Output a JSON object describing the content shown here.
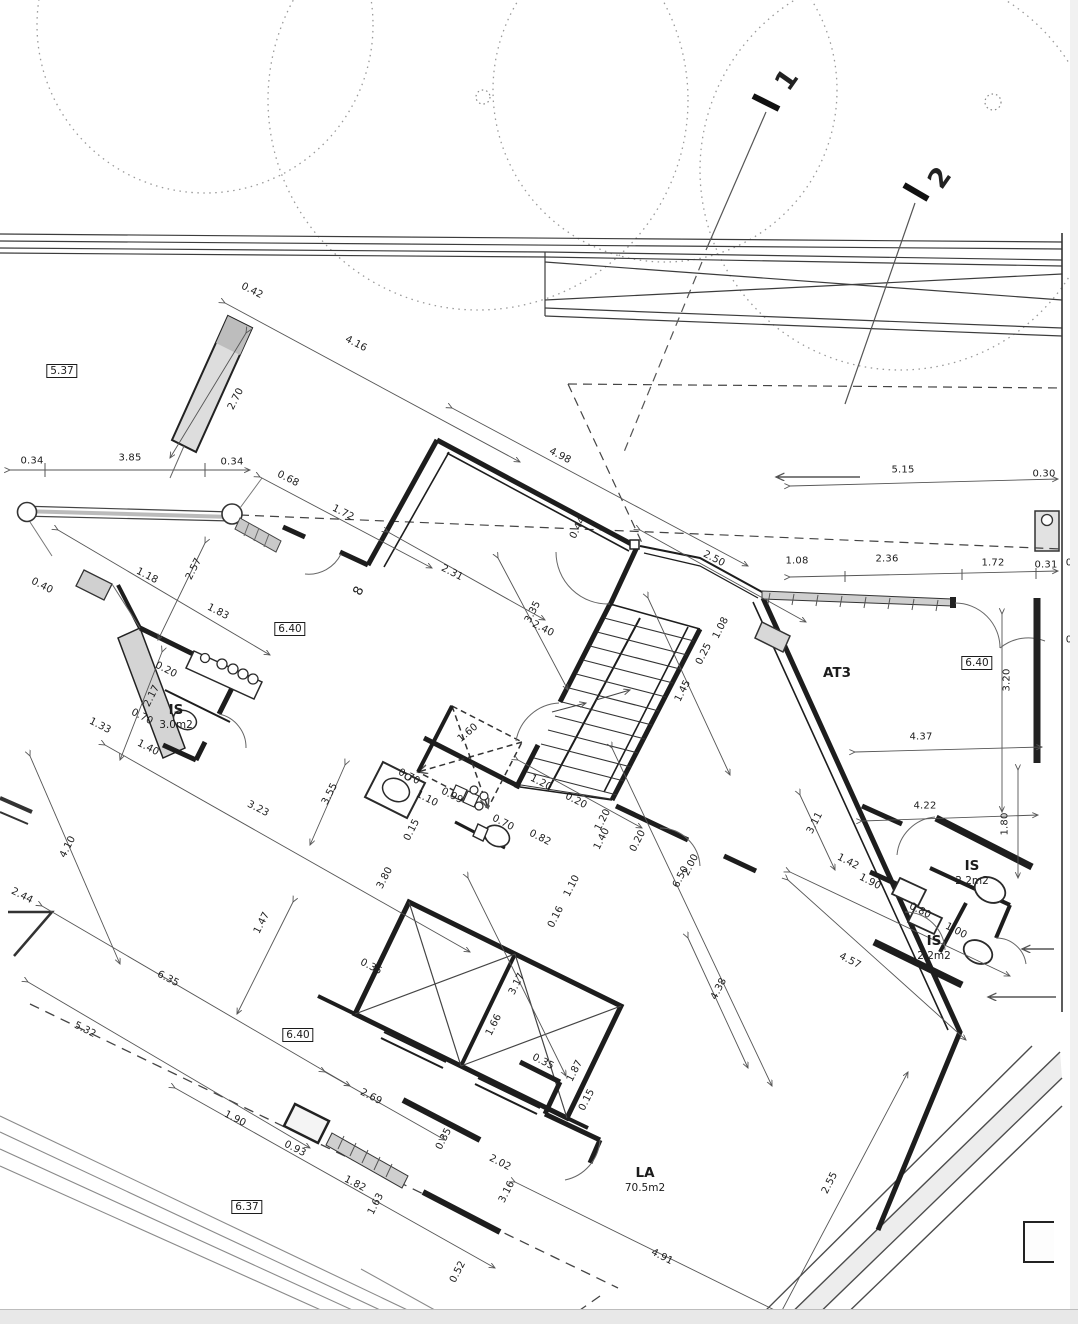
{
  "page": {
    "width": 1078,
    "height": 1324
  },
  "floorplan": {
    "section_markers": [
      {
        "label": "1",
        "x": 787,
        "y": 80,
        "r": -55
      },
      {
        "label": "2",
        "x": 940,
        "y": 178,
        "r": -55
      }
    ],
    "level_markers": [
      {
        "value": "5.37",
        "x": 62,
        "y": 371
      },
      {
        "value": "6.40",
        "x": 290,
        "y": 629
      },
      {
        "value": "6.40",
        "x": 977,
        "y": 663
      },
      {
        "value": "6.40",
        "x": 298,
        "y": 1035
      },
      {
        "value": "6.37",
        "x": 247,
        "y": 1207
      }
    ],
    "rooms": [
      {
        "label": "AT3",
        "area": "",
        "x": 837,
        "y": 674
      },
      {
        "label": "IS",
        "area": "3.0m2",
        "x": 176,
        "y": 717
      },
      {
        "label": "IS",
        "area": "2.2m2",
        "x": 972,
        "y": 873
      },
      {
        "label": "IS",
        "area": "2.2m2",
        "x": 934,
        "y": 948
      },
      {
        "label": "LA",
        "area": "70.5m2",
        "x": 645,
        "y": 1180
      }
    ],
    "wall_tags": [
      {
        "value": "8",
        "x": 359,
        "y": 591,
        "r": -63
      }
    ],
    "dimensions": [
      {
        "v": "0.34",
        "x": 32,
        "y": 461,
        "r": 0
      },
      {
        "v": "3.85",
        "x": 130,
        "y": 458,
        "r": 0
      },
      {
        "v": "0.34",
        "x": 232,
        "y": 462,
        "r": 0
      },
      {
        "v": "0.42",
        "x": 252,
        "y": 291,
        "r": 27
      },
      {
        "v": "4.16",
        "x": 356,
        "y": 344,
        "r": 27
      },
      {
        "v": "2.70",
        "x": 236,
        "y": 399,
        "r": -63
      },
      {
        "v": "0.68",
        "x": 288,
        "y": 479,
        "r": 27
      },
      {
        "v": "1.72",
        "x": 343,
        "y": 513,
        "r": 27
      },
      {
        "v": "5.15",
        "x": 903,
        "y": 470,
        "r": 0
      },
      {
        "v": "0.30",
        "x": 1044,
        "y": 474,
        "r": 0
      },
      {
        "v": "1.08",
        "x": 797,
        "y": 561,
        "r": 0
      },
      {
        "v": "2.36",
        "x": 887,
        "y": 559,
        "r": 0
      },
      {
        "v": "1.72",
        "x": 993,
        "y": 563,
        "r": 0
      },
      {
        "v": "0.31",
        "x": 1046,
        "y": 565,
        "r": 0
      },
      {
        "v": "0",
        "x": 1069,
        "y": 563,
        "r": 0
      },
      {
        "v": "0",
        "x": 1069,
        "y": 640,
        "r": 0
      },
      {
        "v": "2.50",
        "x": 714,
        "y": 559,
        "r": 27
      },
      {
        "v": "4.98",
        "x": 560,
        "y": 456,
        "r": 27
      },
      {
        "v": "0.44",
        "x": 578,
        "y": 528,
        "r": -63
      },
      {
        "v": "2.31",
        "x": 452,
        "y": 573,
        "r": 27
      },
      {
        "v": "3.35",
        "x": 533,
        "y": 612,
        "r": -63
      },
      {
        "v": "2.40",
        "x": 543,
        "y": 629,
        "r": 27
      },
      {
        "v": "1.08",
        "x": 721,
        "y": 628,
        "r": -63
      },
      {
        "v": "0.25",
        "x": 704,
        "y": 654,
        "r": -63
      },
      {
        "v": "1.45",
        "x": 683,
        "y": 691,
        "r": -63
      },
      {
        "v": "1.20",
        "x": 541,
        "y": 783,
        "r": 27
      },
      {
        "v": "0.20",
        "x": 576,
        "y": 801,
        "r": 27
      },
      {
        "v": "1.20",
        "x": 603,
        "y": 820,
        "r": -63
      },
      {
        "v": "1.40",
        "x": 602,
        "y": 839,
        "r": -63
      },
      {
        "v": "0.20",
        "x": 638,
        "y": 841,
        "r": -63
      },
      {
        "v": "1.10",
        "x": 572,
        "y": 886,
        "r": -63
      },
      {
        "v": "6.50",
        "x": 681,
        "y": 877,
        "r": -63
      },
      {
        "v": "2.00",
        "x": 691,
        "y": 865,
        "r": -63
      },
      {
        "v": "4.38",
        "x": 719,
        "y": 989,
        "r": -63
      },
      {
        "v": "1.60",
        "x": 468,
        "y": 733,
        "r": -40
      },
      {
        "v": "0.70",
        "x": 409,
        "y": 777,
        "r": 27
      },
      {
        "v": "1.10",
        "x": 427,
        "y": 799,
        "r": 27
      },
      {
        "v": "0.99",
        "x": 452,
        "y": 796,
        "r": 27
      },
      {
        "v": "0.15",
        "x": 412,
        "y": 830,
        "r": -63
      },
      {
        "v": "0.70",
        "x": 503,
        "y": 823,
        "r": 27
      },
      {
        "v": "0.82",
        "x": 540,
        "y": 838,
        "r": 27
      },
      {
        "v": "3.80",
        "x": 385,
        "y": 878,
        "r": -63
      },
      {
        "v": "2.02",
        "x": 500,
        "y": 1163,
        "r": 27
      },
      {
        "v": "3.16",
        "x": 507,
        "y": 1192,
        "r": -63
      },
      {
        "v": "0.16",
        "x": 556,
        "y": 917,
        "r": -63
      },
      {
        "v": "3.17",
        "x": 517,
        "y": 984,
        "r": -63
      },
      {
        "v": "1.66",
        "x": 494,
        "y": 1025,
        "r": -63
      },
      {
        "v": "0.35",
        "x": 371,
        "y": 967,
        "r": 27
      },
      {
        "v": "0.35",
        "x": 543,
        "y": 1062,
        "r": 27
      },
      {
        "v": "1.87",
        "x": 575,
        "y": 1071,
        "r": -63
      },
      {
        "v": "0.15",
        "x": 587,
        "y": 1100,
        "r": -63
      },
      {
        "v": "2.69",
        "x": 371,
        "y": 1097,
        "r": 27
      },
      {
        "v": "1.47",
        "x": 262,
        "y": 923,
        "r": -63
      },
      {
        "v": "6.35",
        "x": 168,
        "y": 979,
        "r": 27
      },
      {
        "v": "5.32",
        "x": 85,
        "y": 1030,
        "r": 27
      },
      {
        "v": "4.10",
        "x": 68,
        "y": 847,
        "r": -63
      },
      {
        "v": "2.44",
        "x": 22,
        "y": 896,
        "r": 27
      },
      {
        "v": "3.23",
        "x": 258,
        "y": 809,
        "r": 27
      },
      {
        "v": "3.55",
        "x": 330,
        "y": 794,
        "r": -63
      },
      {
        "v": "1.18",
        "x": 147,
        "y": 576,
        "r": 27
      },
      {
        "v": "2.57",
        "x": 194,
        "y": 569,
        "r": -63
      },
      {
        "v": "1.83",
        "x": 218,
        "y": 612,
        "r": 27
      },
      {
        "v": "0.40",
        "x": 42,
        "y": 586,
        "r": 27
      },
      {
        "v": "1.33",
        "x": 100,
        "y": 726,
        "r": 27
      },
      {
        "v": "2.17",
        "x": 152,
        "y": 696,
        "r": -63
      },
      {
        "v": "0.70",
        "x": 142,
        "y": 717,
        "r": 27
      },
      {
        "v": "1.40",
        "x": 148,
        "y": 748,
        "r": 27
      },
      {
        "v": "0.20",
        "x": 166,
        "y": 670,
        "r": 27
      },
      {
        "v": "1.90",
        "x": 235,
        "y": 1119,
        "r": 27
      },
      {
        "v": "0.93",
        "x": 295,
        "y": 1149,
        "r": 27
      },
      {
        "v": "1.82",
        "x": 355,
        "y": 1184,
        "r": 27
      },
      {
        "v": "1.63",
        "x": 376,
        "y": 1204,
        "r": -63
      },
      {
        "v": "0.35",
        "x": 444,
        "y": 1139,
        "r": -63
      },
      {
        "v": "0.52",
        "x": 458,
        "y": 1272,
        "r": -63
      },
      {
        "v": "4.91",
        "x": 662,
        "y": 1257,
        "r": 27
      },
      {
        "v": "2.55",
        "x": 830,
        "y": 1183,
        "r": -63
      },
      {
        "v": "4.37",
        "x": 921,
        "y": 737,
        "r": 0
      },
      {
        "v": "3.20",
        "x": 1007,
        "y": 680,
        "r": -90
      },
      {
        "v": "4.22",
        "x": 925,
        "y": 806,
        "r": 0
      },
      {
        "v": "3.11",
        "x": 815,
        "y": 823,
        "r": -63
      },
      {
        "v": "1.80",
        "x": 1005,
        "y": 824,
        "r": -90
      },
      {
        "v": "1.42",
        "x": 848,
        "y": 862,
        "r": 27
      },
      {
        "v": "1.90",
        "x": 870,
        "y": 882,
        "r": 27
      },
      {
        "v": "0.80",
        "x": 920,
        "y": 911,
        "r": 27
      },
      {
        "v": "1.00",
        "x": 956,
        "y": 931,
        "r": 27
      },
      {
        "v": "4.57",
        "x": 850,
        "y": 961,
        "r": 27
      }
    ]
  }
}
